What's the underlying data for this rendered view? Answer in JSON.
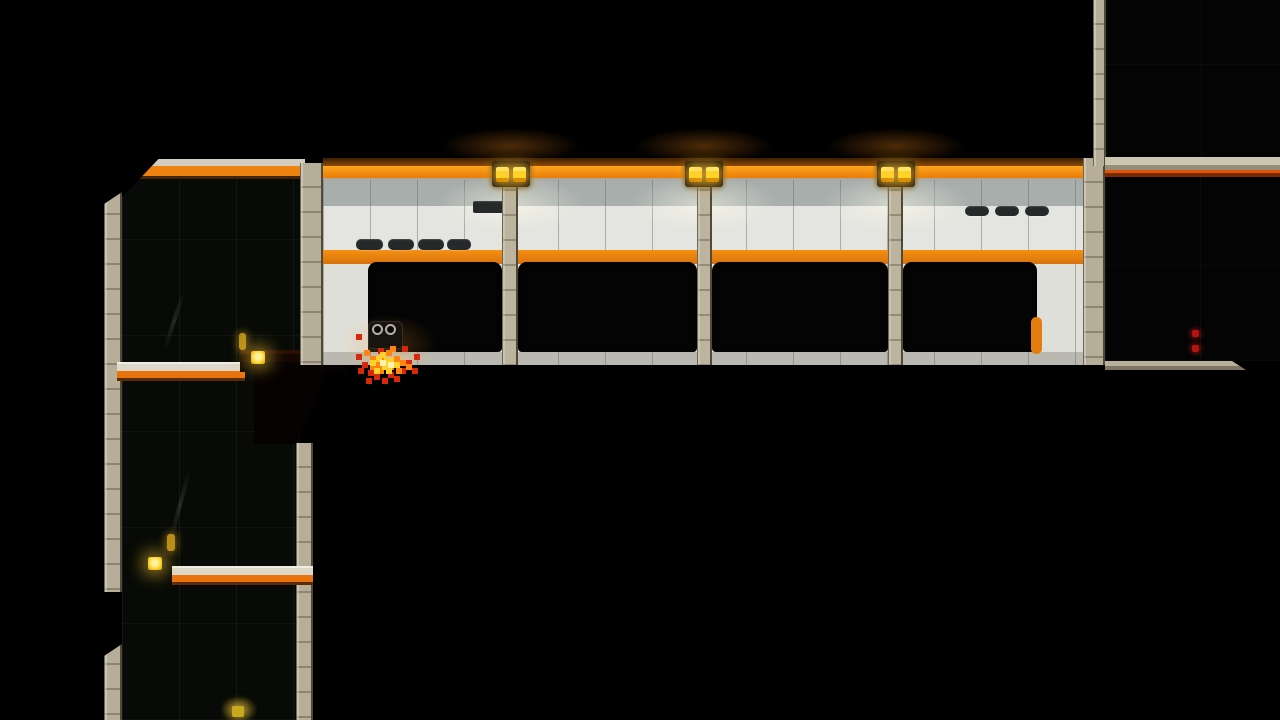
{
  "meta": {
    "domain": "Game",
    "description": "2D side-scrolling stealth platformer level: dark industrial rooms around a lit white-tiled corridor with orange trim; a small goggled clone character stands burning on the corridor floor",
    "resolution": {
      "width": 1280,
      "height": 720
    }
  },
  "palette": {
    "background": "#000000",
    "corridor_band_orange": "#ee8410",
    "corridor_tile_light": "#e4e4e0",
    "corridor_tile_shaded": "#a8aeac",
    "corridor_floor": "#b9b9b1",
    "column_beige": "#b6ae98",
    "window_black": "#040404",
    "vent_dark": "#26292a",
    "lamp_yellow": "#ffd42a",
    "platform_orange": "#e8730c",
    "dark_room": "#070a06",
    "flame_red": "#d8280a",
    "flame_orange": "#ff8414",
    "flame_yellow": "#ffd22a",
    "indicator_red": "#b61212",
    "door_handle_orange": "#e27c0e"
  },
  "level": {
    "corridor": {
      "ceiling_lamp_fixtures": 3,
      "lamps_per_fixture": 2,
      "window_openings": 4,
      "wall_vents_lower_left": 4,
      "wall_vents_upper_left": 1,
      "wall_vents_right": 3,
      "orange_handle_on_last_window": 1
    },
    "left_tower": {
      "lit_platforms": 2,
      "small_wall_lights": 4,
      "bottom_glow_light": 1,
      "smoke_streaks": 2
    },
    "right_area": {
      "red_indicator_dots": 2,
      "ramp_ended_ledge": 1,
      "upper_floor_with_red_trim": 1
    },
    "player": {
      "state": "burning",
      "position": {
        "x": 385,
        "y": 340
      },
      "accessory": "goggles"
    }
  }
}
